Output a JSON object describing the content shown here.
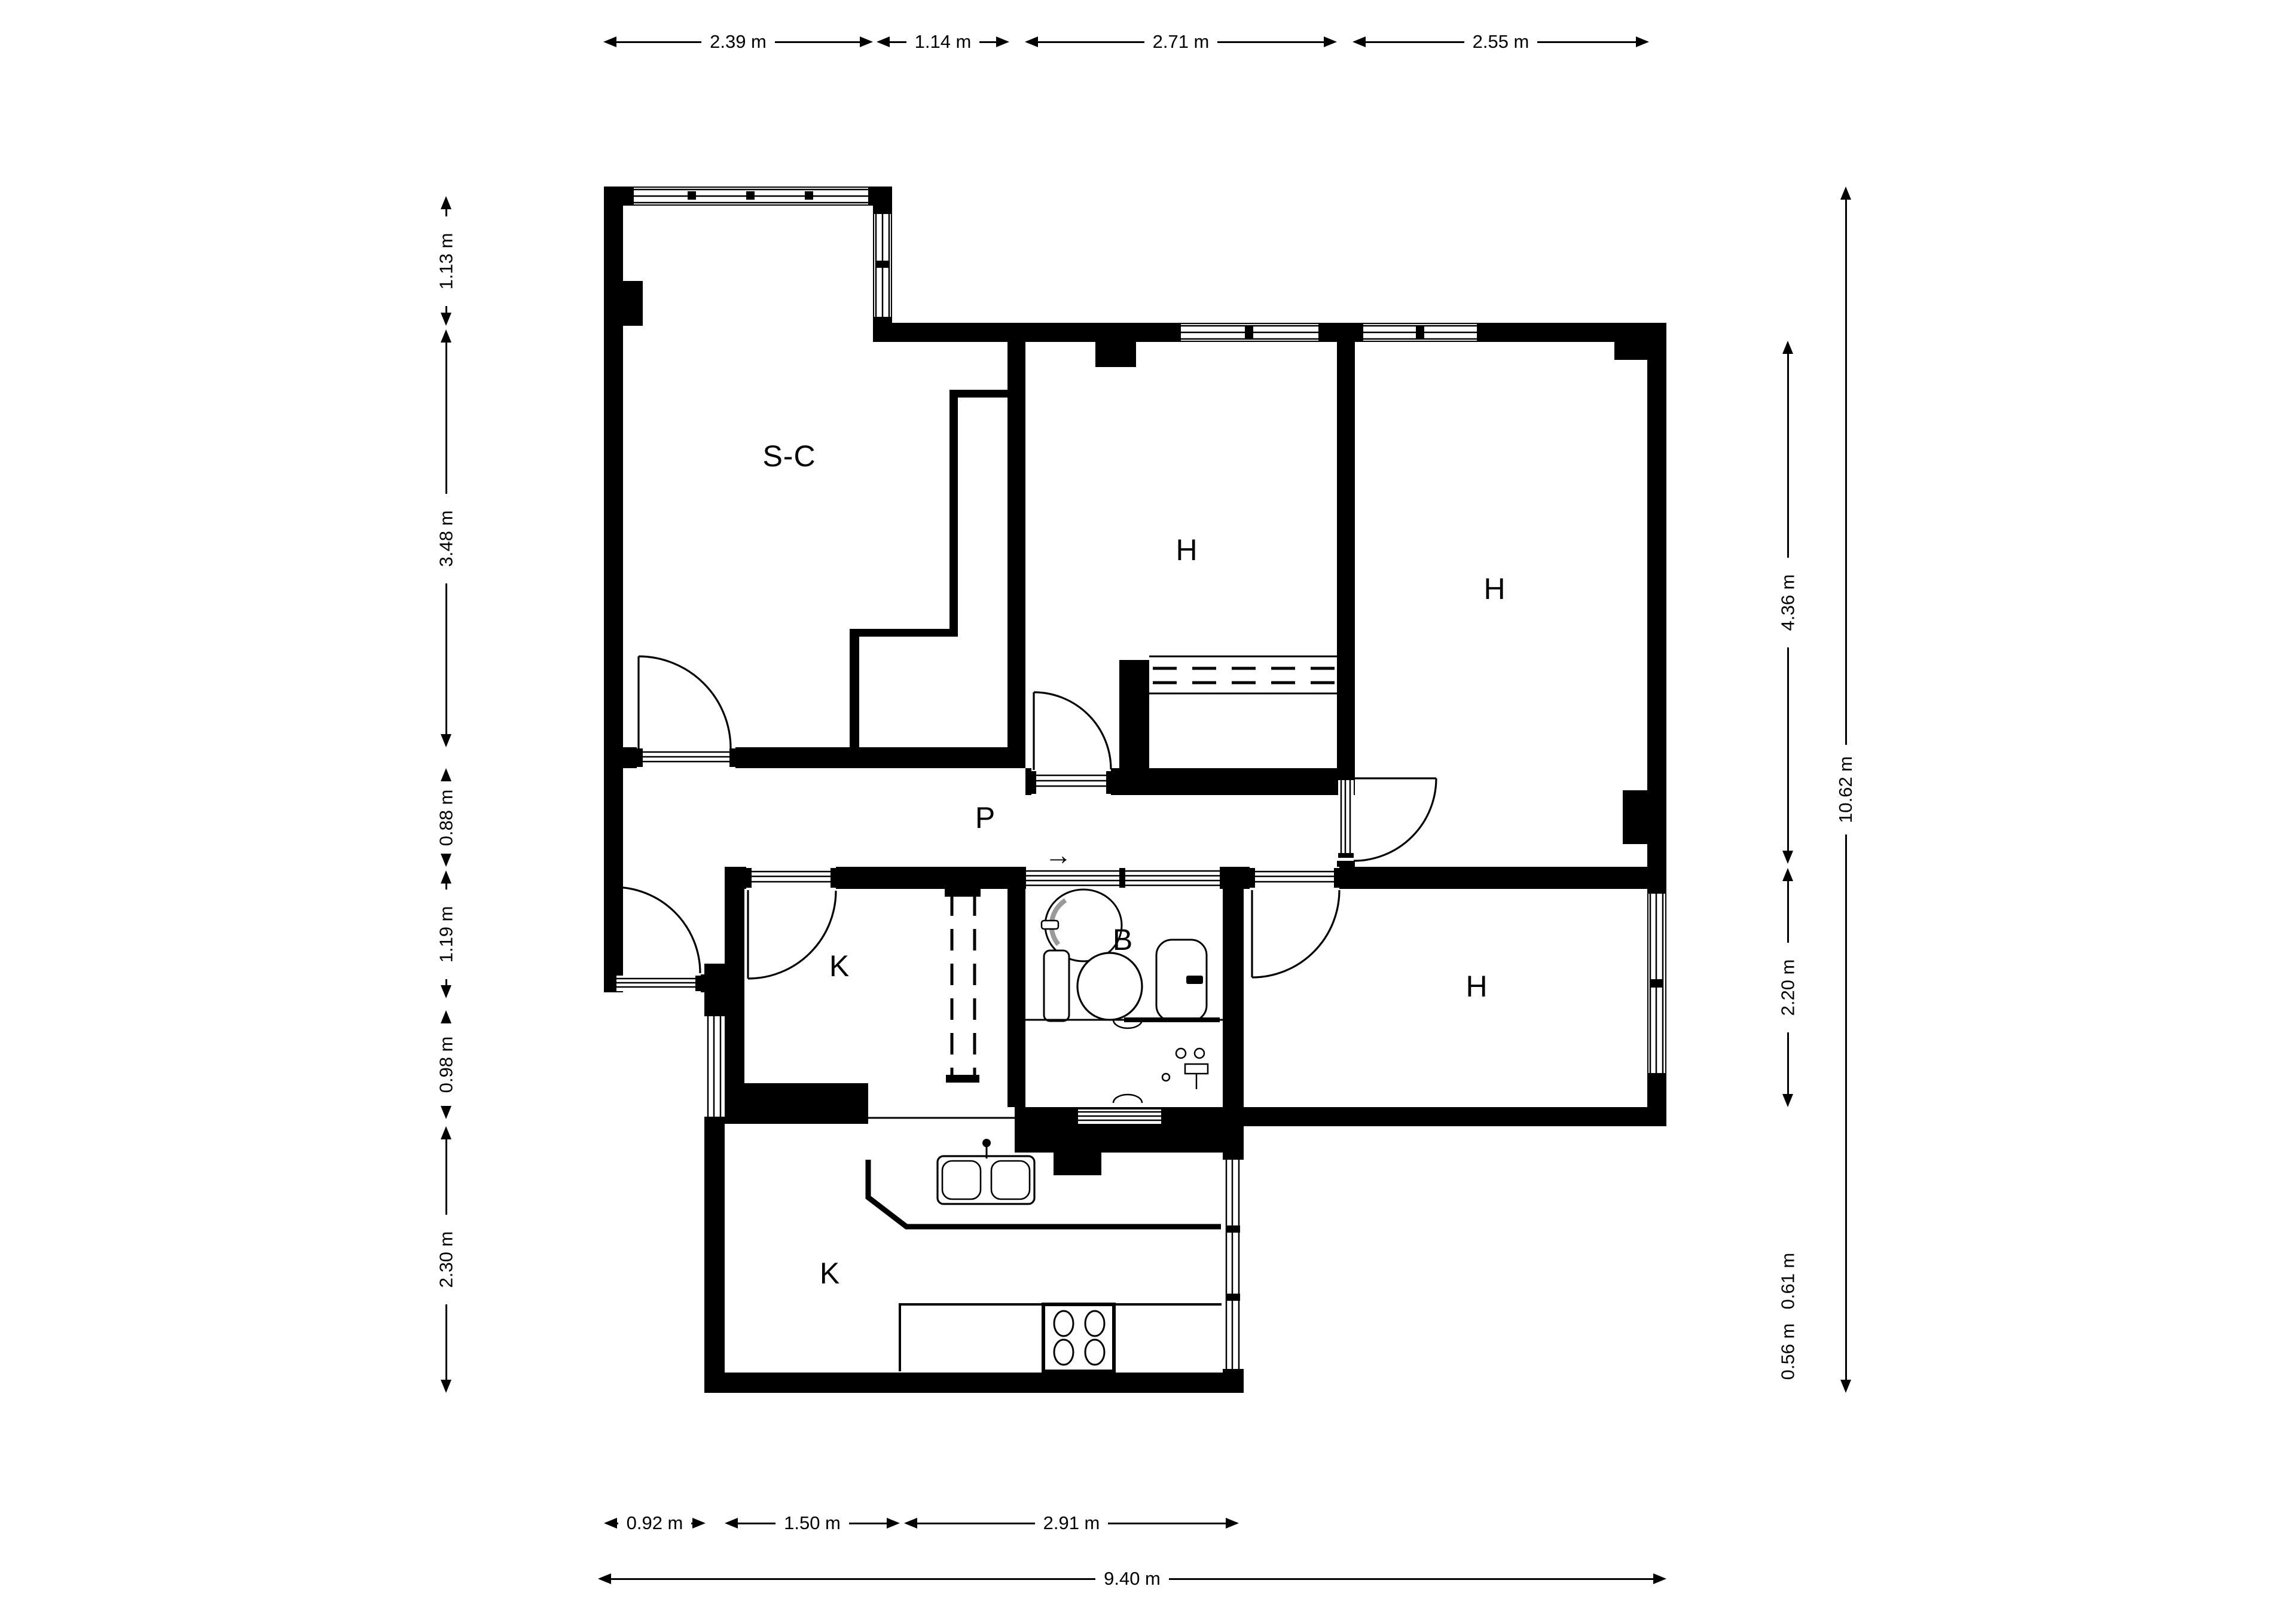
{
  "page": {
    "background": "#ffffff",
    "ink": "#000000"
  },
  "rooms": {
    "living": {
      "label": "S-C"
    },
    "bedroom1": {
      "label": "H"
    },
    "bedroom2": {
      "label": "H"
    },
    "bedroom3": {
      "label": "H"
    },
    "hall": {
      "label": "P"
    },
    "storage": {
      "label": "K"
    },
    "bathroom": {
      "label": "B"
    },
    "kitchen": {
      "label": "K"
    }
  },
  "symbols": {
    "entry_arrow": "→"
  },
  "dimensions": {
    "top": [
      {
        "label": "2.39 m"
      },
      {
        "label": "1.14 m"
      },
      {
        "label": "2.71 m"
      },
      {
        "label": "2.55 m"
      }
    ],
    "left": [
      {
        "label": "1.13 m"
      },
      {
        "label": "3.48 m"
      },
      {
        "label": "0.88 m"
      },
      {
        "label": "1.19 m"
      },
      {
        "label": "0.98 m"
      },
      {
        "label": "2.30 m"
      }
    ],
    "right_inner": [
      {
        "label": "4.36 m"
      },
      {
        "label": "2.20 m"
      }
    ],
    "right_text": [
      {
        "label": "0.61 m"
      },
      {
        "label": "0.56 m"
      }
    ],
    "right_outer": [
      {
        "label": "10.62 m"
      }
    ],
    "bottom_upper": [
      {
        "label": "0.92 m"
      },
      {
        "label": "1.50 m"
      },
      {
        "label": "2.91 m"
      }
    ],
    "bottom_outer": [
      {
        "label": "9.40 m"
      }
    ]
  }
}
